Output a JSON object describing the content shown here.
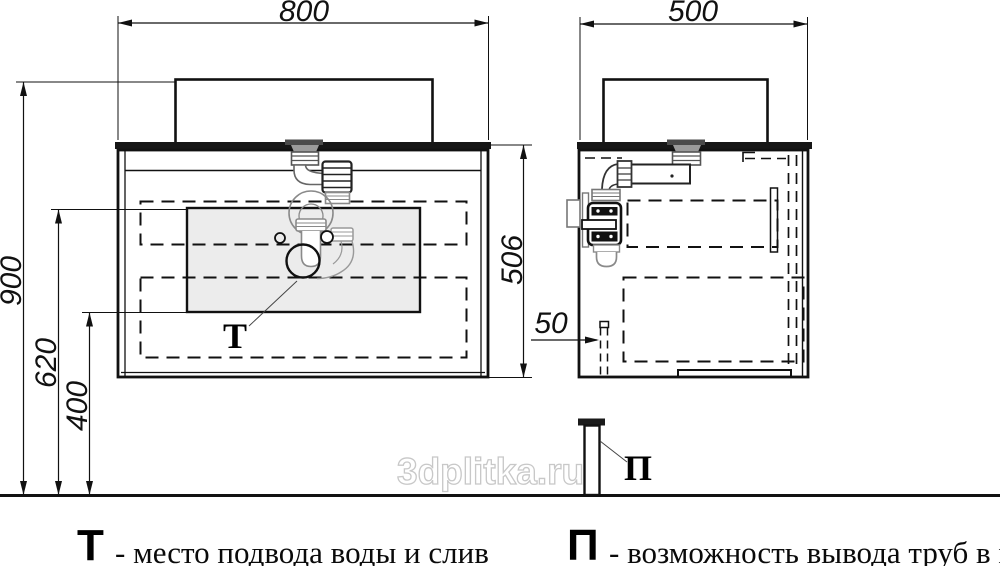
{
  "drawing": {
    "front_view": {
      "width": "800",
      "mount_height": "900",
      "supply_zone_top": "620",
      "supply_zone_bottom": "400",
      "cabinet_height": "506",
      "marker": "Т"
    },
    "side_view": {
      "depth": "500",
      "pipe_offset": "50",
      "marker": "П"
    },
    "legend": [
      {
        "symbol": "Т",
        "text": "- место подвода воды и слив"
      },
      {
        "symbol": "П",
        "text": "- возможность вывода труб в пол"
      }
    ],
    "watermark": "3dplitka.ru",
    "colors": {
      "line": "#111111",
      "fitting_gray": "#8a8a8a",
      "panel_fill": "#ececec",
      "watermark_outline": "#c8c8c8"
    }
  }
}
